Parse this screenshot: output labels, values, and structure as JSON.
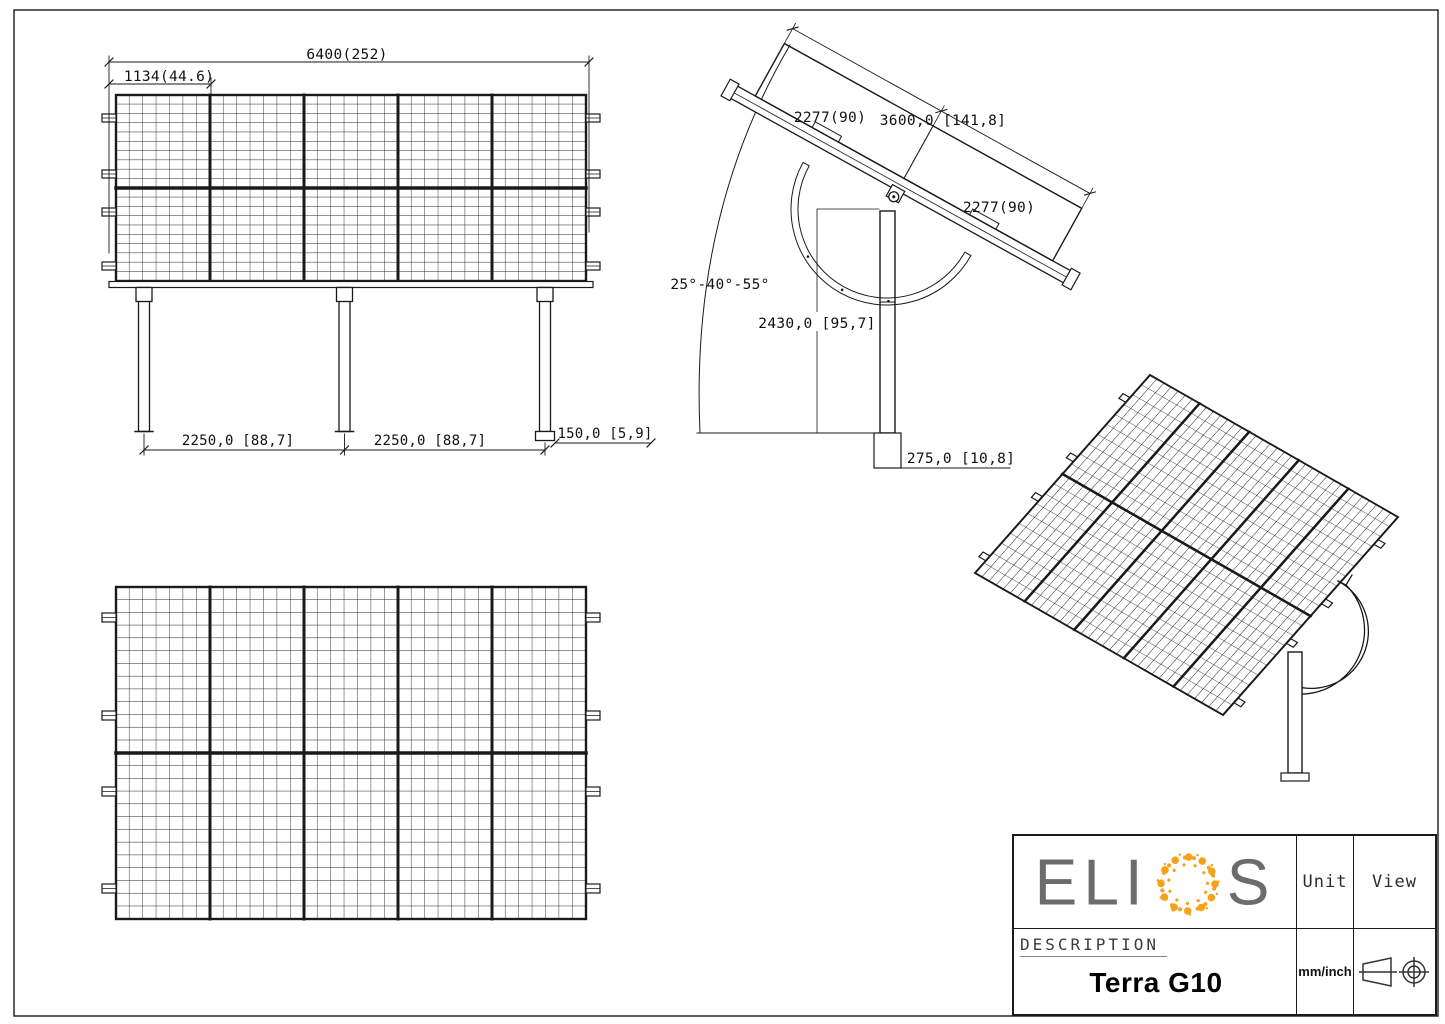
{
  "front_view": {
    "dim_total_width": "6400(252)",
    "dim_module_width": "1134(44.6)",
    "dim_span_left": "2250,0 [88,7]",
    "dim_span_right": "2250,0 [88,7]",
    "dim_base_plate": "150,0 [5,9]"
  },
  "side_view": {
    "dim_module_upper": "2277(90)",
    "dim_total_length": "3600,0 [141,8]",
    "dim_module_lower": "2277(90)",
    "tilt_angle_range": "25°-40°-55°",
    "dim_post_height": "2430,0 [95,7]",
    "dim_embed_depth": "275,0 [10,8]"
  },
  "title_block": {
    "brand_left": "ELI",
    "brand_right": "S",
    "brand_name": "ELIOS",
    "unit_label": "Unit",
    "view_label": "View",
    "description_label": "DESCRIPTION",
    "product_name": "Terra G10",
    "unit_value": "mm/inch"
  },
  "colors": {
    "line": "#1a1a1a",
    "brand_gray": "#6b6c6e",
    "brand_orange": "#F5A21B"
  }
}
